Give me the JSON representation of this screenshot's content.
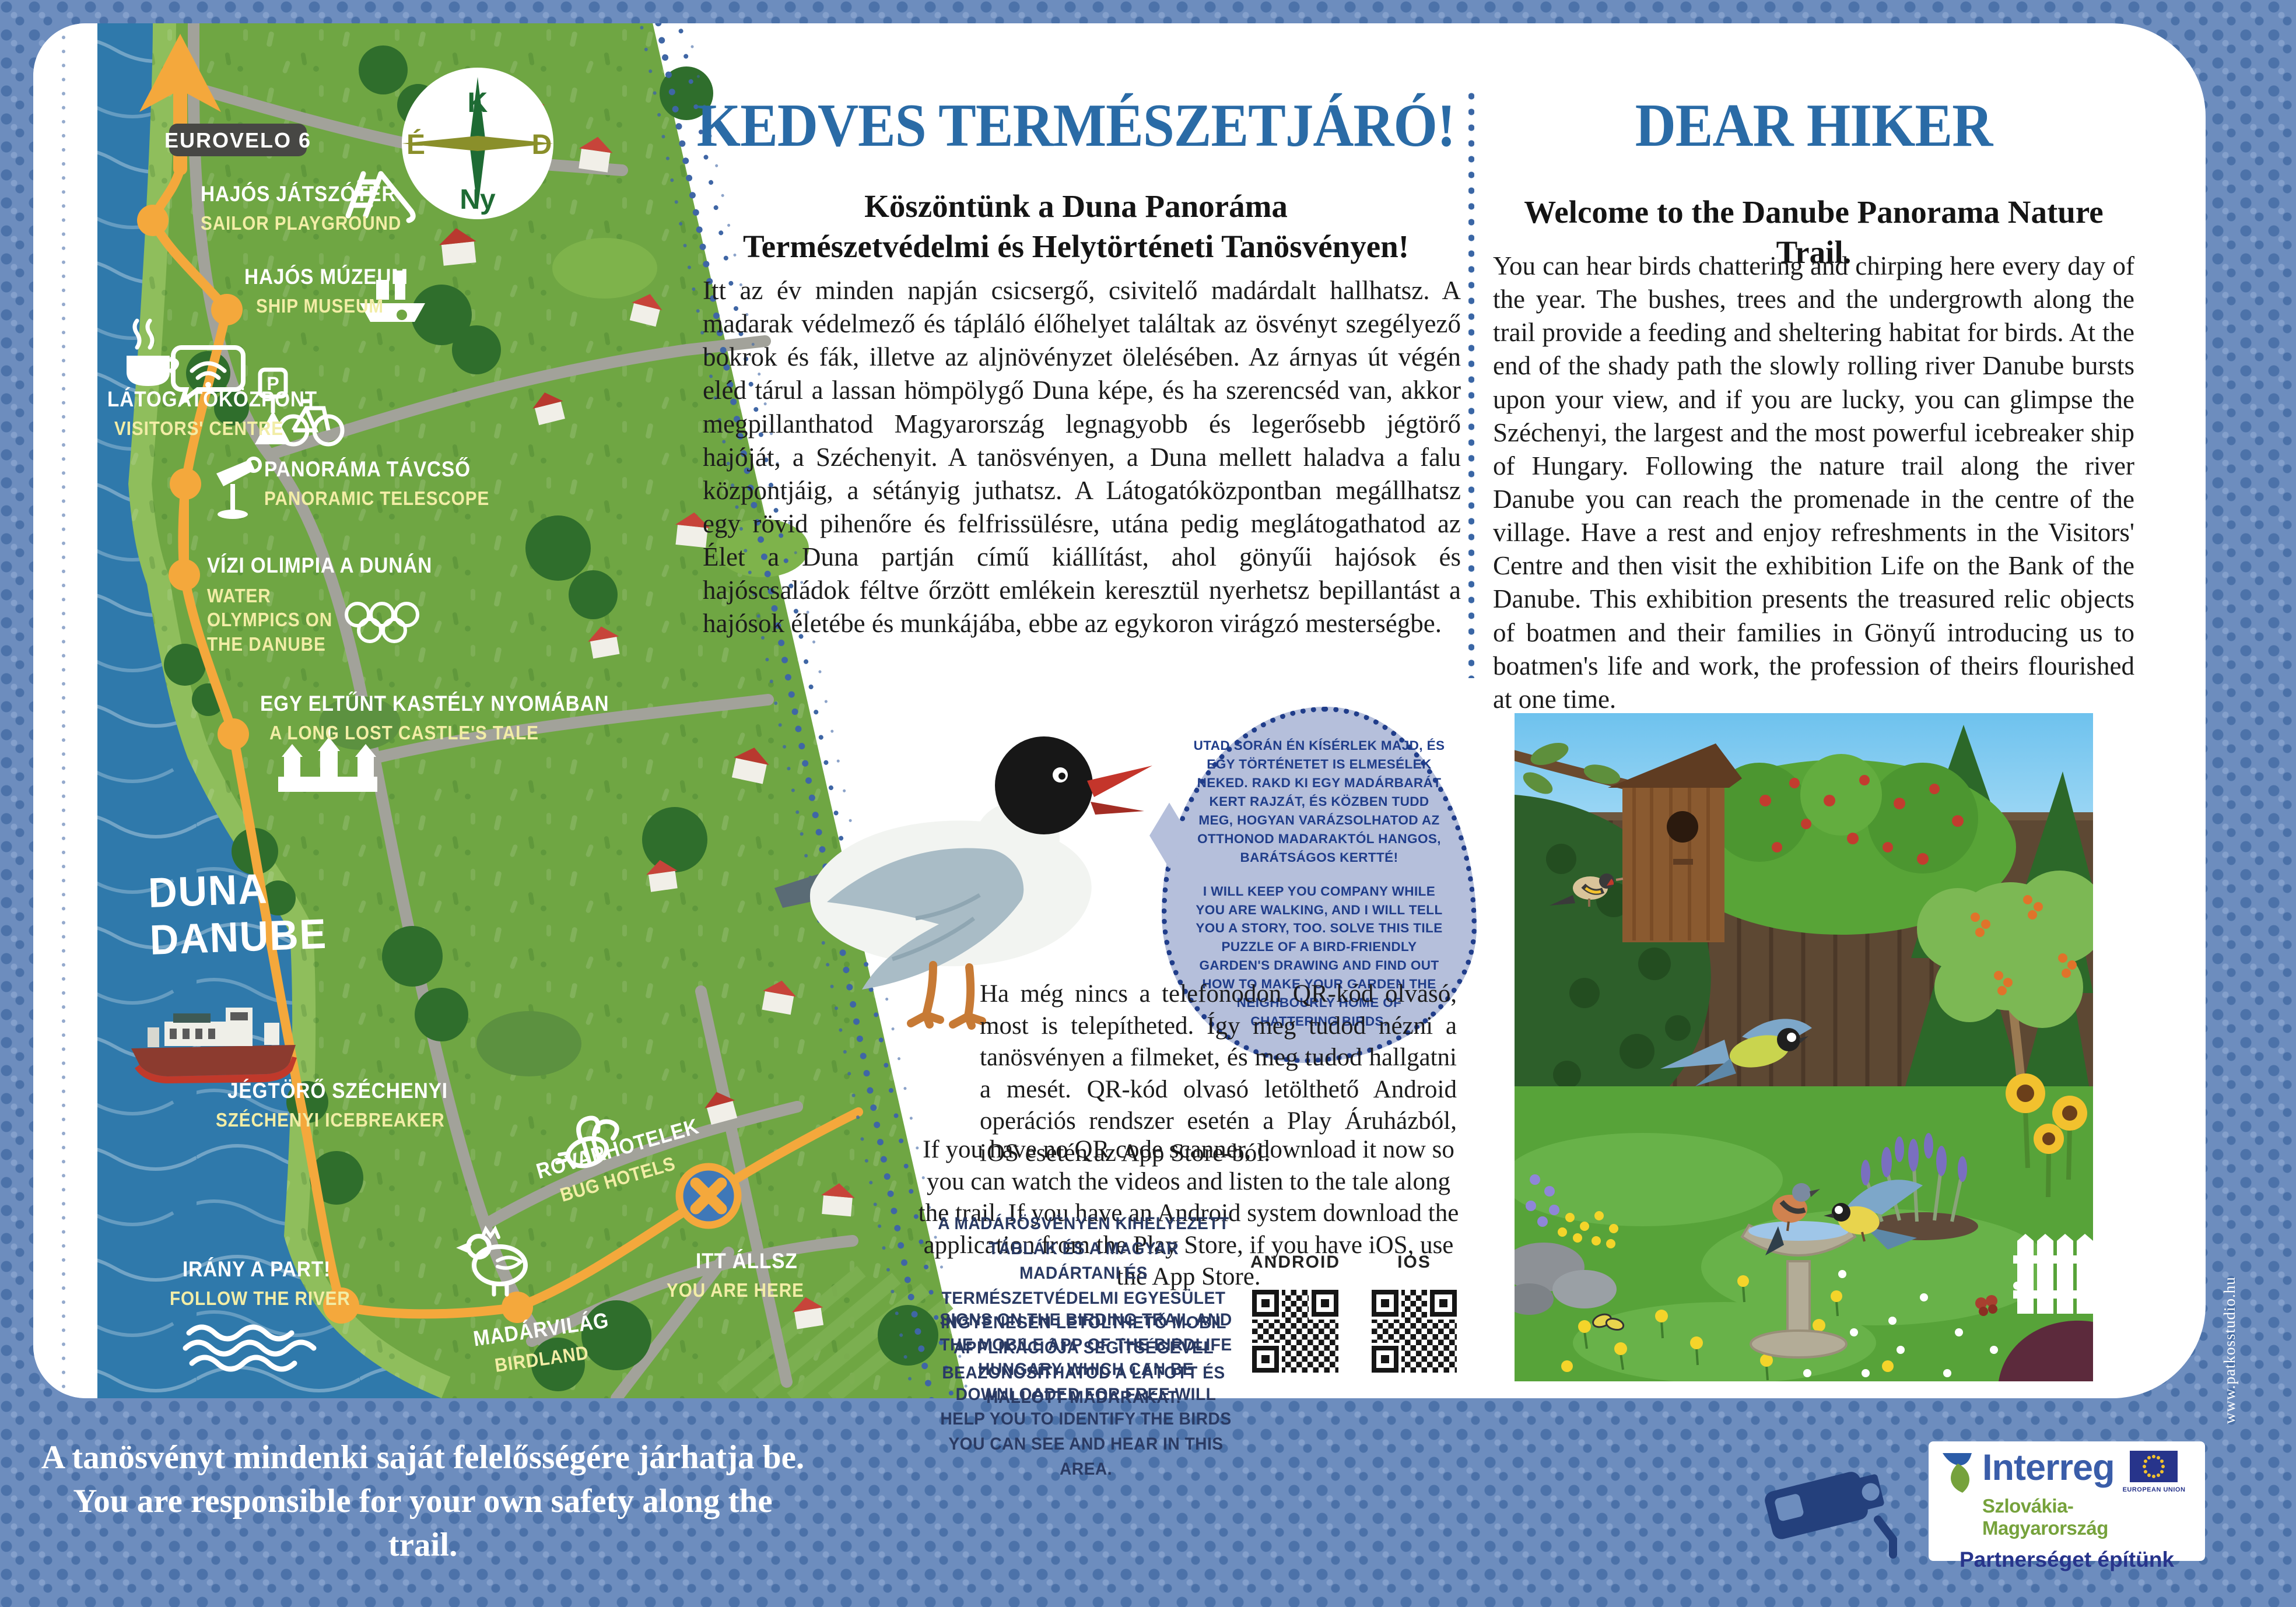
{
  "panel": {
    "hu": {
      "title": "KEDVES TERMÉSZETJÁRÓ!",
      "subtitle": "Köszöntünk a Duna Panoráma\nTermészetvédelmi és Helytörténeti Tanösvényen!",
      "body": "Itt az év minden napján csicsergő, csivitelő madárdalt hallhatsz. A madarak védelmező és tápláló élőhelyet találtak az ösvényt szegélyező bokrok és fák, illetve az aljnövényzet ölelésében. Az árnyas út végén eléd tárul a lassan hömpölygő Duna képe, és ha szerencséd van, akkor megpillanthatod Magyarország legnagyobb és legerősebb jégtörő hajóját, a Széchenyit. A tanösvényen, a Duna mellett haladva a falu központjáig, a sétányig juthatsz. A Látogatóközpontban megállhatsz egy rövid pihenőre és felfrissülésre, utána pedig meglátogathatod az Élet a Duna partján című kiállítást, ahol gönyűi hajósok és hajóscsaládok féltve őrzött emlékein keresztül nyerhetsz bepillantást a hajósok életébe és munkájába, ebbe az egykoron virágzó mesterségbe."
    },
    "en": {
      "title": "DEAR HIKER",
      "subtitle": "Welcome to the Danube Panorama Nature Trail.",
      "body": "You can hear birds chattering and chirping here every day of the year. The bushes, trees and the undergrowth along the trail provide a feeding and sheltering habitat for birds. At the end of the shady path the slowly rolling river Danube bursts upon your view, and if you are lucky, you can glimpse the Széchenyi, the largest and the most powerful icebreaker ship of Hungary. Following the nature trail along the river Danube you can reach the promenade in the centre of the village. Have a rest and enjoy refreshments in the Visitors' Centre and then visit the exhibition Life on the Bank of the Danube. This exhibition presents the treasured relic objects of boatmen and their families in Gönyű introducing us to boatmen's life and work, the profession of theirs flourished at one time."
    }
  },
  "map": {
    "eurovelo": "EUROVELO 6",
    "parking_letter": "P",
    "compass": {
      "top": "K",
      "right": "D",
      "bottom": "Ny",
      "left": "É"
    },
    "river": {
      "hu": "DUNA",
      "en": "DANUBE"
    },
    "stations": [
      {
        "hu": "HAJÓS JÁTSZÓTÉR",
        "en": "SAILOR PLAYGROUND"
      },
      {
        "hu": "HAJÓS MÚZEUM",
        "en": "SHIP MUSEUM"
      },
      {
        "hu": "LÁTOGATÓKÖZPONT",
        "en": "VISITORS' CENTRE"
      },
      {
        "hu": "PANORÁMA TÁVCSŐ",
        "en": "PANORAMIC TELESCOPE"
      },
      {
        "hu": "VÍZI OLIMPIA A DUNÁN",
        "en": "WATER OLYMPICS ON THE DANUBE"
      },
      {
        "hu": "EGY ELTŰNT KASTÉLY NYOMÁBAN",
        "en": "A LONG LOST CASTLE'S TALE"
      },
      {
        "hu": "JÉGTÖRŐ SZÉCHENYI",
        "en": "SZÉCHENYI ICEBREAKER"
      },
      {
        "hu": "ROVARHOTELEK",
        "en": "BUG HOTELS"
      },
      {
        "hu": "MADÁRVILÁG",
        "en": "BIRDLAND"
      },
      {
        "hu": "ITT ÁLLSZ",
        "en": "YOU ARE HERE"
      },
      {
        "hu": "IRÁNY A PART!",
        "en": "FOLLOW THE RIVER"
      }
    ]
  },
  "bubble": {
    "hu": "UTAD SORÁN ÉN KÍSÉRLEK MAJD, ÉS EGY TÖRTÉNETET IS ELMESÉLEK NEKED. RAKD KI EGY MADÁRBARÁT KERT RAJZÁT, ÉS KÖZBEN TUDD MEG, HOGYAN VARÁZSOLHATOD AZ OTTHONOD MADARAKTÓL HANGOS, BARÁTSÁGOS KERTTÉ!",
    "en": "I WILL KEEP YOU COMPANY WHILE YOU ARE WALKING, AND I WILL TELL YOU A STORY, TOO. SOLVE THIS TILE PUZZLE OF A BIRD-FRIENDLY GARDEN'S DRAWING AND FIND OUT HOW TO MAKE YOUR GARDEN THE NEIGHBOURLY HOME OF CHATTERING BIRDS."
  },
  "qr": {
    "hu": "Ha még nincs a telefonodon QR-kód olvasó, most is telepítheted. Így meg tudod nézni a tanösvényen a filmeket, és meg tudod hallgatni a mesét. QR-kód olvasó letölthető Android operációs rendszer esetén a Play Áruházból, iOS esetén az App Store-ból.",
    "en": "If you have no QR code scanner, download it now so you can watch the videos and listen to the tale along the trail. If you have an Android system download the application from the Play Store, if you have iOS, use the App Store.",
    "note_hu": "A MADÁRÖSVÉNYEN KIHELYEZETT TÁBLÁK ÉS A MAGYAR MADÁRTANI ÉS TERMÉSZETVÉDELMI EGYESÜLET INGYENESEN LETÖLTHETŐ MOBIL APPLIKÁCIÓJA SEGÍTSÉGÉVEL BEAZONOSÍTHATOD A LÁTOTT ÉS HALLOTT MADARAKAT.",
    "note_en": "SIGNS ON THE BIRDING TRAIL AND THE MOBILE APP OF THE BIRDLIFE HUNGARY WHICH CAN BE DOWNLOADED FOR FREE WILL HELP YOU TO IDENTIFY THE BIRDS YOU CAN SEE AND HEAR IN THIS AREA.",
    "android": "ANDROID",
    "ios": "IOS"
  },
  "footer": {
    "disclaimer_hu": "A tanösvényt mindenki saját felelősségére járhatja be.",
    "disclaimer_en": "You are responsible for your own safety along the trail.",
    "credit": "www.patkosstudio.hu"
  },
  "interreg": {
    "brand": "Interreg",
    "region": "Szlovákia-Magyarország",
    "tagline": "Partnerséget építünk",
    "eu_label": "EUROPEAN UNION"
  },
  "colors": {
    "accent_blue": "#2a6ba6",
    "trail_orange": "#f4a83c",
    "bubble_navy": "#203d8a",
    "frame_blue": "#6d8dbe",
    "map_green": "#6fa643",
    "river_blue": "#2f79ab"
  }
}
